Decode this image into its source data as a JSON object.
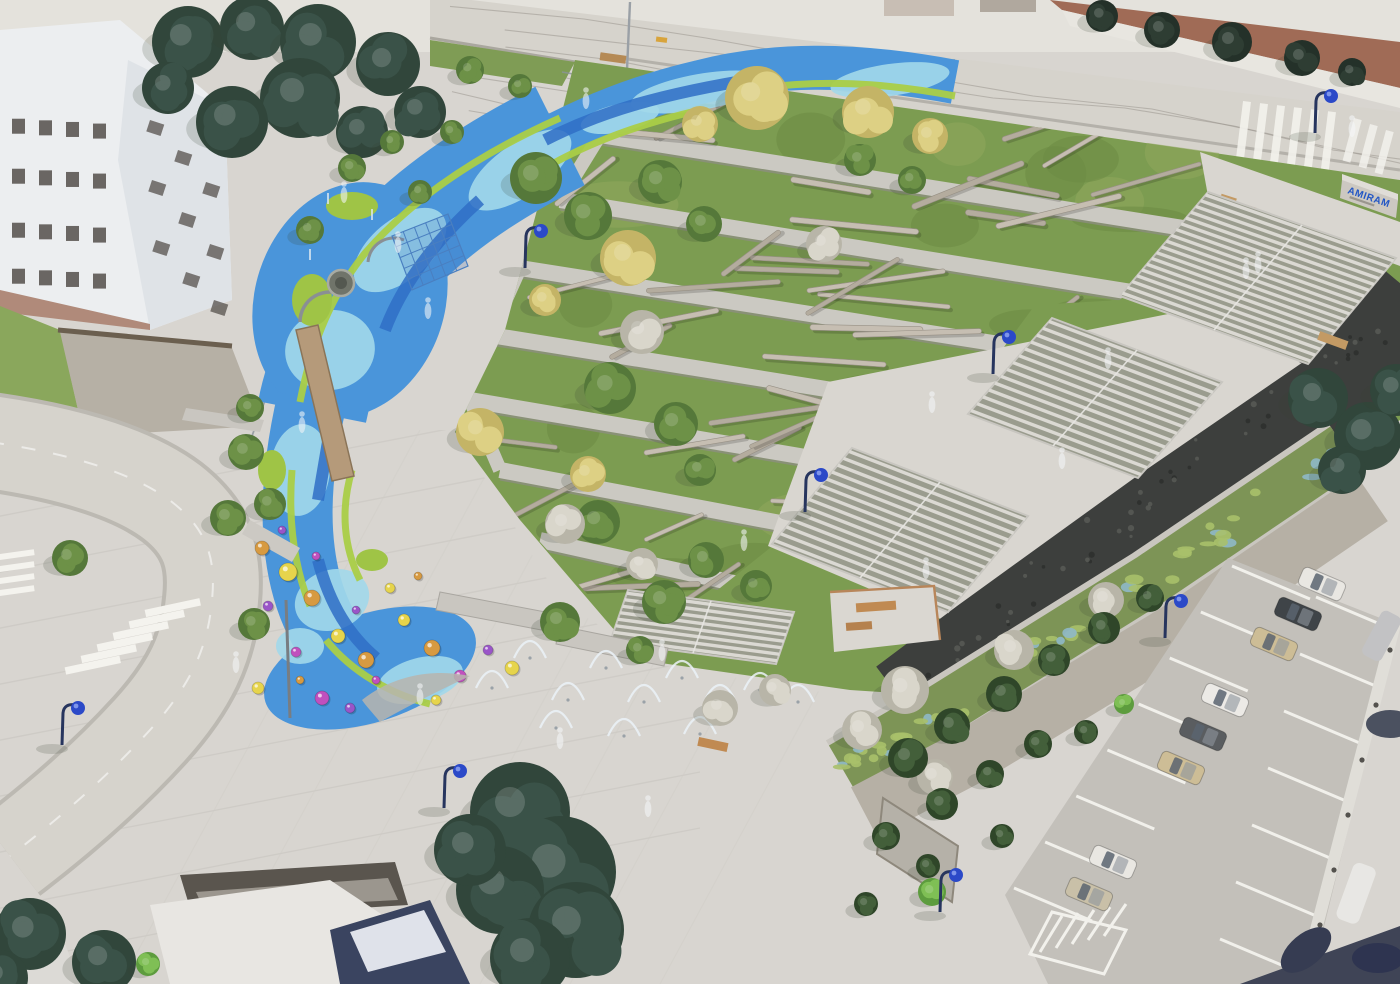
{
  "meta": {
    "title": "Aerial rendering of terraced hillside park",
    "view": "aerial-oblique architectural visualization",
    "features": [
      "water play stream",
      "log-scattered green terraces",
      "grand stairs",
      "gabion wall",
      "rain garden",
      "gravel path",
      "parking lot",
      "plaza with splash jets"
    ]
  },
  "sign": {
    "text": "AMIRAM"
  },
  "palette": {
    "paving": "#d8d5d0",
    "asphalt": "#d6d3cc",
    "grass": "#7c9c51",
    "grass_dark": "#5e7d3c",
    "water_mid": "#4a95da",
    "water_light": "#a2d8ea",
    "water_deep": "#2f6ec6",
    "lime": "#aace47",
    "log": "#c2bab0",
    "stair_tread": "#dbd9d3",
    "stair_riser": "#979a8b",
    "gabion": "#3d3f3d",
    "gravel": "#b6b0a5",
    "tree_green": "#6d9147",
    "tree_yellow": "#ddd084",
    "tree_white": "#d9d6cb",
    "tree_dark": "#31463b",
    "conifer": "#435f3a",
    "bright_green": "#7fbf55",
    "lamp_blue": "#2b49c8",
    "sign_blue": "#2256c5",
    "red_dirt": "#a06b56",
    "wood": "#c08a52"
  },
  "inventory": {
    "street_lamps": 8,
    "parked_cars": 8,
    "stair_flights": 4,
    "play_balls": 23,
    "crosswalks": 3,
    "ghost_people": 18
  }
}
